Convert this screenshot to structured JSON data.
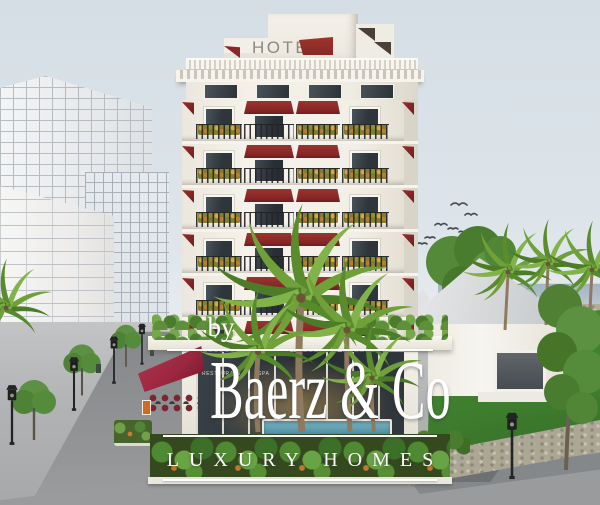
{
  "scene": {
    "label": "Architectural rendering of a white hotel tower with dark-red awnings, flower balconies, palm trees, a street and a seaside villa"
  },
  "rooftop_sign": {
    "text": "HOTEL"
  },
  "storefront_signs": {
    "left": "RESTAURANT",
    "center": "SPA",
    "right": "HOTEL"
  },
  "watermark": {
    "prefix": "by",
    "brand": "Baerz & Co",
    "tagline": "LUXURY HOMES"
  },
  "palette": {
    "sky_top": "#d5dee5",
    "sky_low": "#e9edf0",
    "sea": "#a3b4c1",
    "facade": "#f3f0e9",
    "awning": "#872726",
    "awning_dark": "#6e1d1f",
    "terrace_awning": "#9c2740",
    "glass": "#2e353b",
    "railing": "#26262a",
    "flowers": "#d8a83c",
    "lawn": "#3e7d2e",
    "street": "#919395",
    "sidewalk": "#c3c4c5",
    "stone": "#aca695",
    "wireframe": "#eef0f1",
    "wireframe_line": "#b6bcc2",
    "sign_grey": "#8e897c",
    "watermark": "#ffffff"
  }
}
